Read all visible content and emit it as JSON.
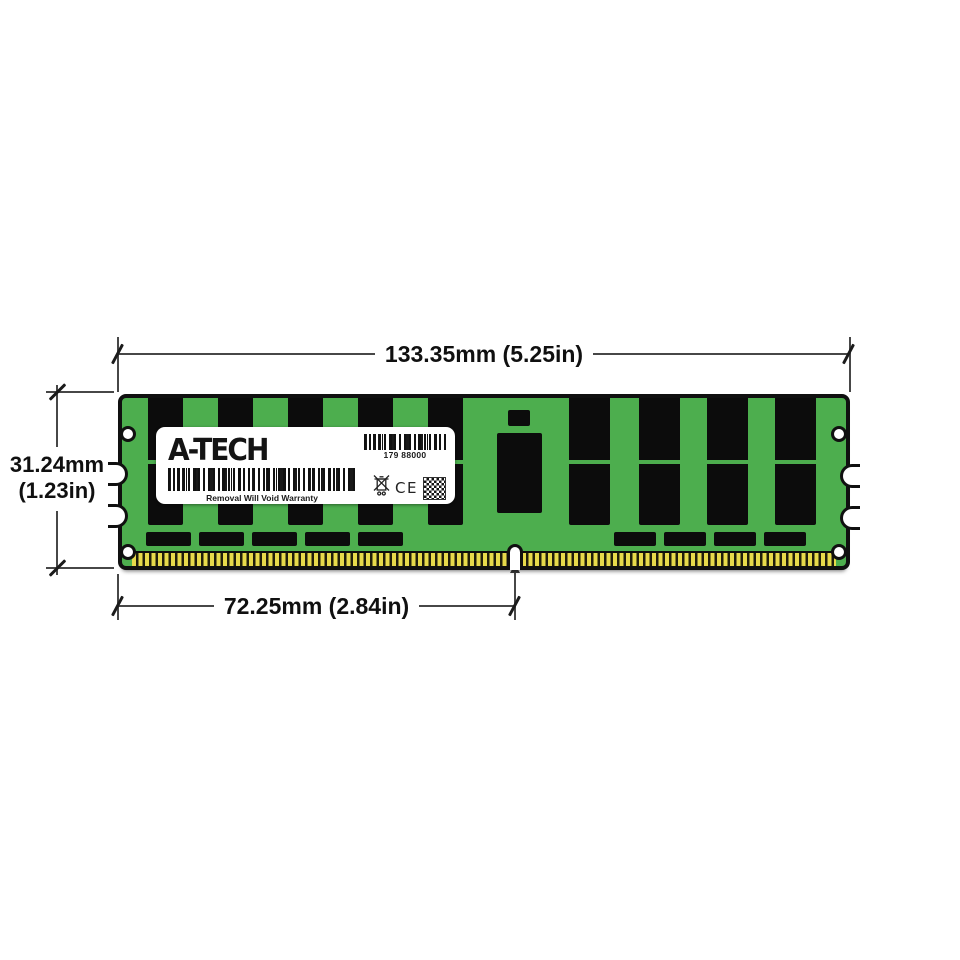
{
  "dimensions": {
    "top": {
      "label": "133.35mm (5.25in)"
    },
    "left": {
      "line1": "31.24mm",
      "line2": "(1.23in)"
    },
    "bottom": {
      "label": "72.25mm (2.84in)"
    }
  },
  "module": {
    "label": {
      "brand": "A-TECH",
      "serial": "179 88000",
      "warning": "Removal Will Void Warranty",
      "ce_mark": "CE"
    },
    "icons": [
      "barcode",
      "weee-crossed-bin-icon",
      "ce-mark",
      "qr-code"
    ],
    "colors": {
      "pcb_green": "#4dae4e",
      "chip_black": "#0c0c0c",
      "pin_gold": "#e7da4b",
      "outline_black": "#101010"
    }
  }
}
